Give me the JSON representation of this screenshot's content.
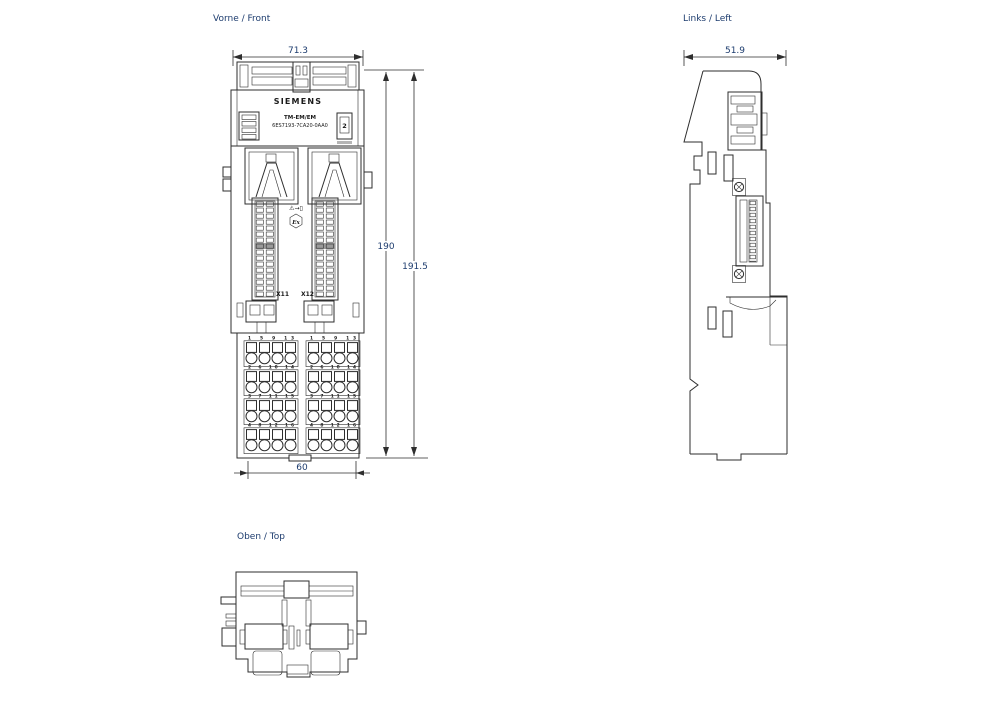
{
  "drawing": {
    "front": {
      "view_label": "Vorne / Front",
      "dim_width": "71.3",
      "dim_height_rail": "190",
      "dim_height_total": "191.5",
      "dim_width_bottom": "60",
      "brand": "SIEMENS",
      "module_type": "TM-EM/EM",
      "order_number": "6ES7193-7CA20-0AA0",
      "slot_number": "2",
      "warning_symbols": "⚠→▯",
      "ex_marking": "Ex",
      "connector_left_label": "X11",
      "connector_right_label": "X12",
      "terminal_rows": [
        "1 5 9 13",
        "2 6 10 14",
        "3 7 11 15",
        "4 8 12 16"
      ]
    },
    "left": {
      "view_label": "Links / Left",
      "dim_depth": "51.9"
    },
    "top": {
      "view_label": "Oben / Top"
    },
    "colors": {
      "line": "#2e2e2e",
      "dimension_text": "#1d3c6e",
      "gray_accent": "#9a9a9a"
    }
  }
}
